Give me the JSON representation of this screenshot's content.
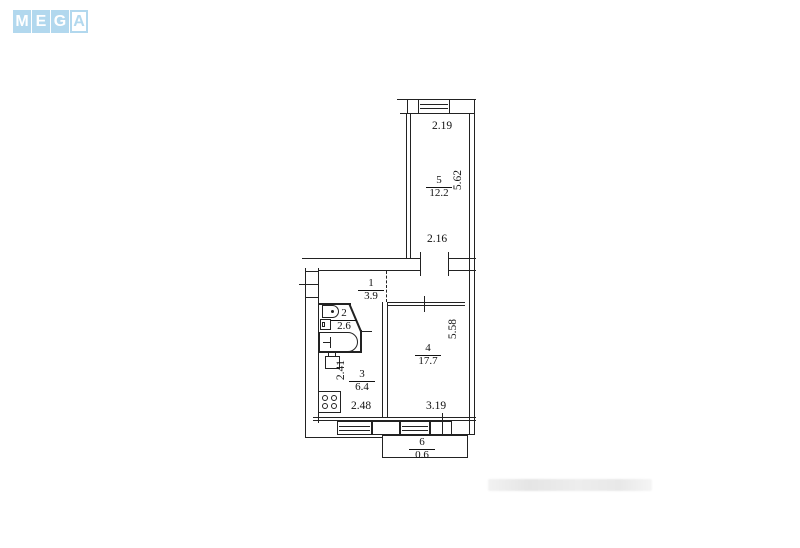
{
  "logo": {
    "letters": [
      "M",
      "E",
      "G",
      "A"
    ],
    "tile_color": "#b2d8ee",
    "letter_color": "#ffffff"
  },
  "plan": {
    "line_color": "#222222",
    "room5": {
      "num": "5",
      "area": "12.2",
      "dim_top": "2.19",
      "dim_right": "5.62",
      "dim_bottom": "2.16"
    },
    "room1": {
      "num": "1",
      "area": "3.9"
    },
    "room2": {
      "num": "2",
      "area": "2.6"
    },
    "room3": {
      "num": "3",
      "area": "6.4",
      "dim_left": "2.41",
      "dim_bottom": "2.48"
    },
    "room4": {
      "num": "4",
      "area": "17.7",
      "dim_right": "5.58",
      "dim_bottom": "3.19"
    },
    "room6": {
      "num": "6",
      "area": "0.6"
    }
  }
}
